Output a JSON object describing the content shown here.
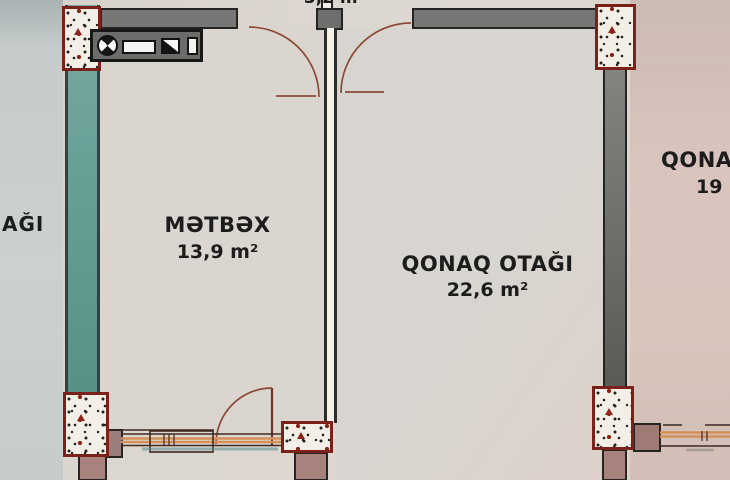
{
  "plan": {
    "type": "apartment-floor-plan",
    "rooms": {
      "kitchen": {
        "name": "MƏTBƏX",
        "area": "13,9 m²"
      },
      "living_room": {
        "name": "QONAQ OTAĞI",
        "area": "22,6 m²"
      },
      "hall_top": {
        "area": "3,2 m²"
      },
      "adjacent_left": {
        "label": "AĞI"
      },
      "adjacent_right": {
        "label": "QONA",
        "area": "19"
      }
    },
    "icons": {
      "kitchen_counter_symbols": [
        "burner-dial-icon",
        "sink-basin-icon",
        "half-shaded-square-icon",
        "narrow-cabinet-icon"
      ]
    },
    "colors": {
      "floor": "#dad5cf",
      "left_region": "#cbd1d0",
      "right_region": "#d9c4bc",
      "wall_teal": "#68a098",
      "wall_gray": "#777775",
      "wall_mauve": "#a8837e",
      "column_fill": "#f3efe7",
      "column_border": "#7c201a",
      "door_arc": "#8d4b37",
      "window_accent": "#d49057",
      "text": "#1c1c1c"
    }
  }
}
